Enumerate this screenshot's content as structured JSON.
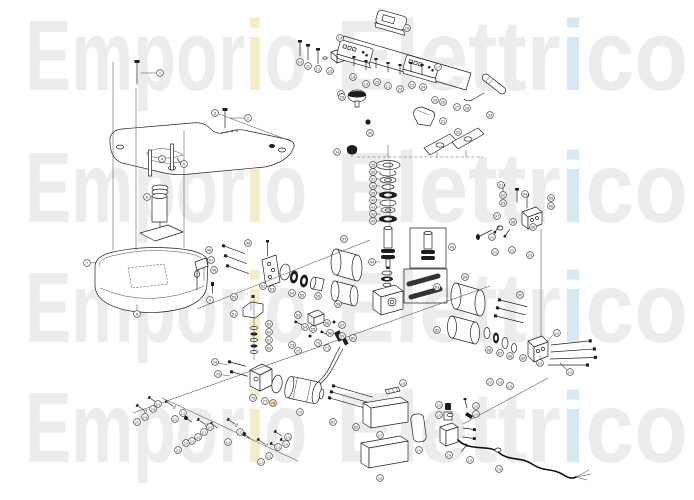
{
  "watermark": {
    "full": "Emporio Elettrico",
    "word1_pre": "Empor",
    "word1_accent": "i",
    "word1_post": "o",
    "word2_pre": "Elettr",
    "word2_accent": "i",
    "word2_post": "co",
    "base_color": "#ececec",
    "accent_yellow": "#f5edc8",
    "accent_blue": "#d6e8f2",
    "rows_y": [
      90,
      222,
      342,
      462
    ]
  },
  "diagram": {
    "description": "Exploded spare-parts diagram of espresso machine with numbered callouts",
    "line_color": "#222222",
    "leader_color": "#555555",
    "callout_numbering": "sequential starting at 1 in array order",
    "highlighted_callout": 78,
    "highlight_color": "#ffe9a0",
    "callouts": [
      [
        160,
        73
      ],
      [
        248,
        118
      ],
      [
        215,
        113
      ],
      [
        162,
        159
      ],
      [
        184,
        164
      ],
      [
        147,
        197
      ],
      [
        87,
        263
      ],
      [
        137,
        314
      ],
      [
        210,
        300
      ],
      [
        300,
        62
      ],
      [
        308,
        66
      ],
      [
        318,
        69
      ],
      [
        330,
        71
      ],
      [
        340,
        38
      ],
      [
        341,
        94
      ],
      [
        407,
        28
      ],
      [
        438,
        67
      ],
      [
        353,
        77
      ],
      [
        366,
        84
      ],
      [
        377,
        82
      ],
      [
        388,
        86
      ],
      [
        400,
        89
      ],
      [
        412,
        85
      ],
      [
        423,
        87
      ],
      [
        435,
        100
      ],
      [
        443,
        102
      ],
      [
        457,
        107
      ],
      [
        467,
        108
      ],
      [
        342,
        97
      ],
      [
        370,
        133
      ],
      [
        443,
        121
      ],
      [
        458,
        132
      ],
      [
        490,
        115
      ],
      [
        337,
        152
      ],
      [
        373,
        165
      ],
      [
        373,
        172
      ],
      [
        373,
        179
      ],
      [
        373,
        186
      ],
      [
        373,
        193
      ],
      [
        373,
        200
      ],
      [
        373,
        207
      ],
      [
        373,
        214
      ],
      [
        373,
        221
      ],
      [
        372,
        262
      ],
      [
        452,
        247
      ],
      [
        209,
        250
      ],
      [
        211,
        260
      ],
      [
        214,
        270
      ],
      [
        248,
        243
      ],
      [
        234,
        297
      ],
      [
        234,
        314
      ],
      [
        263,
        286
      ],
      [
        272,
        289
      ],
      [
        292,
        293
      ],
      [
        302,
        295
      ],
      [
        318,
        296
      ],
      [
        344,
        239
      ],
      [
        338,
        304
      ],
      [
        269,
        324
      ],
      [
        269,
        332
      ],
      [
        269,
        340
      ],
      [
        269,
        348
      ],
      [
        298,
        315
      ],
      [
        305,
        327
      ],
      [
        313,
        329
      ],
      [
        327,
        323
      ],
      [
        342,
        325
      ],
      [
        330,
        333
      ],
      [
        342,
        336
      ],
      [
        318,
        343
      ],
      [
        327,
        348
      ],
      [
        298,
        351
      ],
      [
        292,
        345
      ],
      [
        215,
        362
      ],
      [
        218,
        374
      ],
      [
        253,
        398
      ],
      [
        265,
        401
      ],
      [
        273,
        403
      ],
      [
        300,
        412
      ],
      [
        353,
        338
      ],
      [
        333,
        422
      ],
      [
        356,
        427
      ],
      [
        437,
        287
      ],
      [
        465,
        277
      ],
      [
        437,
        330
      ],
      [
        489,
        350
      ],
      [
        500,
        353
      ],
      [
        510,
        356
      ],
      [
        523,
        358
      ],
      [
        520,
        295
      ],
      [
        501,
        185
      ],
      [
        503,
        195
      ],
      [
        503,
        203
      ],
      [
        525,
        194
      ],
      [
        551,
        198
      ],
      [
        551,
        206
      ],
      [
        497,
        216
      ],
      [
        513,
        222
      ],
      [
        533,
        227
      ],
      [
        492,
        237
      ],
      [
        495,
        252
      ],
      [
        512,
        250
      ],
      [
        530,
        255
      ],
      [
        557,
        333
      ],
      [
        540,
        363
      ],
      [
        570,
        372
      ],
      [
        137,
        422
      ],
      [
        145,
        417
      ],
      [
        153,
        409
      ],
      [
        158,
        404
      ],
      [
        175,
        419
      ],
      [
        183,
        413
      ],
      [
        178,
        450
      ],
      [
        186,
        443
      ],
      [
        192,
        441
      ],
      [
        198,
        437
      ],
      [
        204,
        432
      ],
      [
        210,
        427
      ],
      [
        228,
        442
      ],
      [
        240,
        432
      ],
      [
        261,
        462
      ],
      [
        269,
        456
      ],
      [
        278,
        447
      ],
      [
        286,
        444
      ],
      [
        288,
        437
      ],
      [
        403,
        383
      ],
      [
        380,
        435
      ],
      [
        380,
        478
      ],
      [
        419,
        450
      ],
      [
        439,
        405
      ],
      [
        439,
        415
      ],
      [
        476,
        406
      ],
      [
        476,
        414
      ],
      [
        449,
        455
      ],
      [
        470,
        460
      ],
      [
        499,
        469
      ],
      [
        490,
        382
      ],
      [
        500,
        382
      ],
      [
        510,
        386
      ]
    ],
    "leaders": [
      [
        113,
        62,
        113,
        250
      ],
      [
        136,
        88,
        136,
        250
      ],
      [
        184,
        131,
        184,
        248
      ],
      [
        156,
        73,
        141,
        73
      ],
      [
        244,
        118,
        230,
        118
      ],
      [
        219,
        114,
        293,
        142
      ],
      [
        91,
        263,
        97,
        262
      ],
      [
        137,
        310,
        137,
        304
      ],
      [
        390,
        160,
        390,
        226
      ],
      [
        390,
        268,
        390,
        286
      ],
      [
        388,
        145,
        388,
        157
      ],
      [
        352,
        154,
        352,
        157
      ],
      [
        437,
        152,
        437,
        157
      ],
      [
        466,
        150,
        466,
        157
      ],
      [
        254,
        300,
        254,
        360
      ],
      [
        541,
        229,
        541,
        336
      ],
      [
        133,
        413,
        490,
        286
      ],
      [
        197,
        309,
        370,
        240
      ],
      [
        162,
        398,
        298,
        461
      ],
      [
        548,
        378,
        463,
        424
      ],
      [
        376.5,
        165,
        380.5,
        165
      ],
      [
        376.5,
        172,
        380.5,
        172
      ],
      [
        376.5,
        179,
        380.5,
        179
      ],
      [
        376.5,
        186,
        380.5,
        186
      ],
      [
        376.5,
        193,
        380.5,
        193
      ],
      [
        376.5,
        200,
        380.5,
        200
      ],
      [
        376.5,
        207,
        380.5,
        207
      ],
      [
        376.5,
        214,
        380.5,
        214
      ],
      [
        376.5,
        221,
        380.5,
        221
      ],
      [
        375.5,
        262,
        380,
        262
      ],
      [
        213,
        362,
        228,
        365
      ],
      [
        216,
        374,
        230,
        376
      ],
      [
        553,
        335,
        546,
        343
      ],
      [
        540,
        360,
        540,
        355
      ],
      [
        567,
        370,
        560,
        363
      ],
      [
        357,
        157,
        483,
        157,
        1
      ]
    ]
  }
}
